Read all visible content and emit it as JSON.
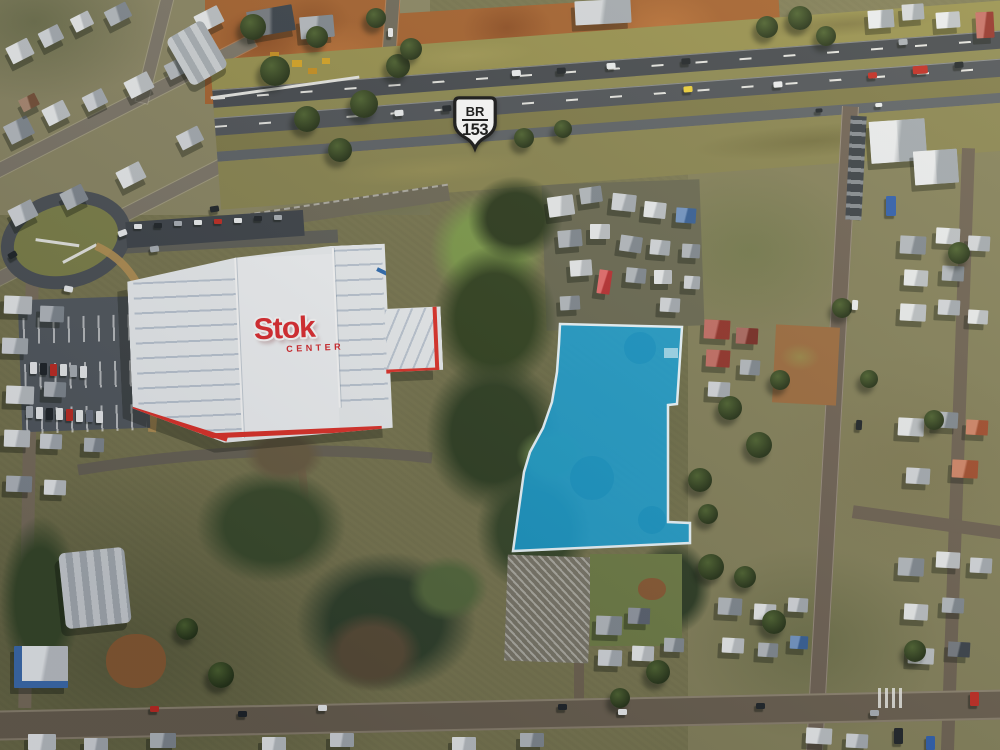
{
  "route_shield": {
    "prefix": "BR",
    "number": "153",
    "background": "#ffffff",
    "border_color": "#151515"
  },
  "store": {
    "name": "Stok",
    "subtitle": "CENTER",
    "logo_red": "#e02a2e",
    "roof_white": "#eef1f3",
    "trim_red": "#e23128",
    "accent_blue": "#2e6cb2"
  },
  "parcel_highlight": {
    "points": "560,324 682,327 677,404 668,405 668,522 690,523 690,543 513,551 524,472 530,452 543,428 552,402 557,372 559,344",
    "fill": "#16a7e1",
    "fill_opacity": "0.85",
    "stroke": "#eefaff",
    "stroke_width": "2.5"
  }
}
